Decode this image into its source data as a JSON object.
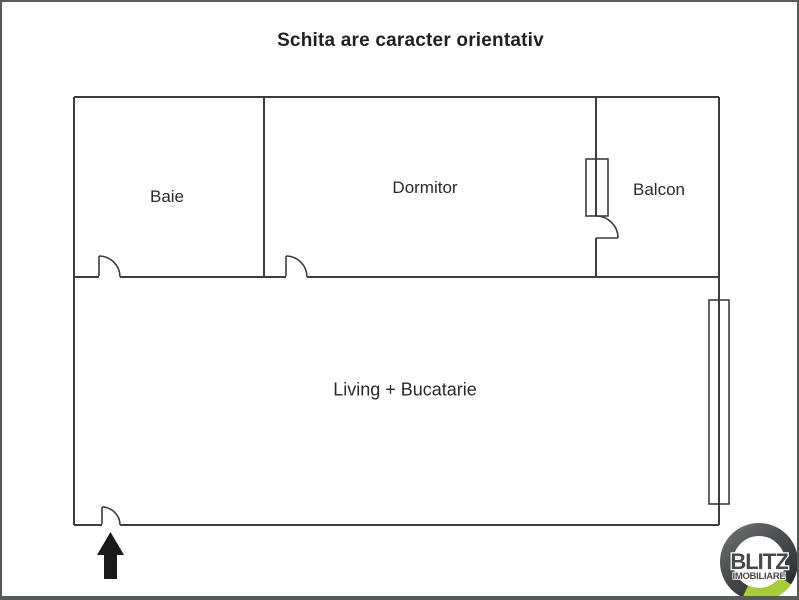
{
  "title": "Schita are caracter orientativ",
  "rooms": {
    "baie": "Baie",
    "dormitor": "Dormitor",
    "balcon": "Balcon",
    "living": "Living + Bucatarie"
  },
  "logo": {
    "brand": "BLITZ",
    "subtitle": "IMOBILIARE",
    "ring_color": "#4a4b4d",
    "accent_green": "#a6ce39"
  },
  "colors": {
    "wall": "#3d3d3d",
    "text": "#2a2a2a",
    "frame_border": "#58595b",
    "arrow": "#1a1a1a",
    "background": "#ffffff"
  }
}
